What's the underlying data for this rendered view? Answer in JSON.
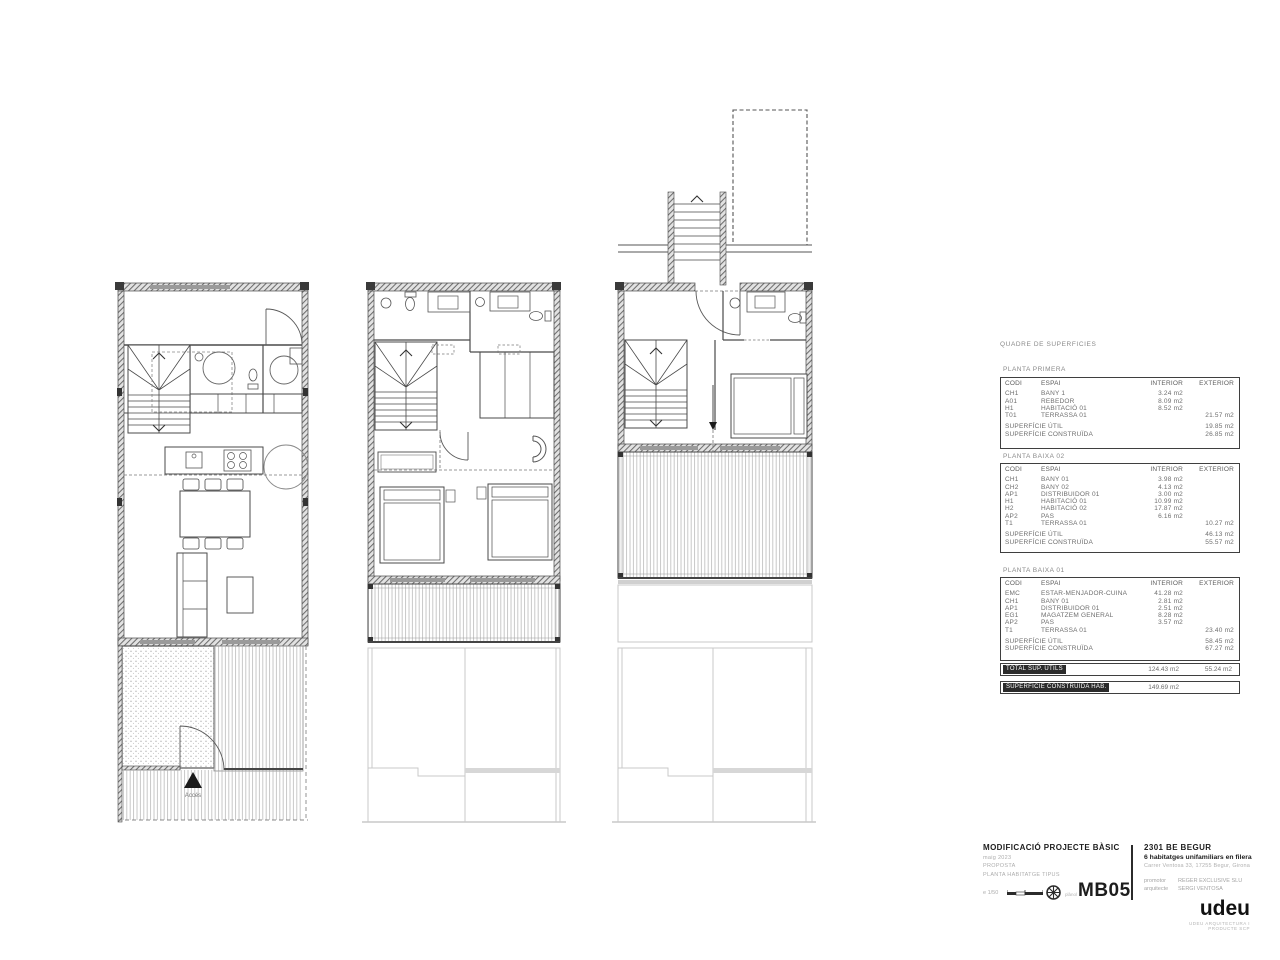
{
  "sheet": {
    "background": "#ffffff",
    "line_color": "#4a4a4a",
    "ghost_color": "#c9c9c9"
  },
  "plans": {
    "acces_label": "Accés"
  },
  "surfaces": {
    "title": "QUADRE DE SUPERFICIES",
    "col_headers": [
      "CODI",
      "ESPAI",
      "INTERIOR",
      "EXTERIOR"
    ],
    "util_label": "SUPERFÍCIE ÚTIL",
    "construida_label": "SUPERFÍCIE CONSTRUÏDA",
    "tables": [
      {
        "name": "PLANTA PRIMERA",
        "rows": [
          {
            "codi": "CH1",
            "espai": "BANY 1",
            "interior": "3.24 m2",
            "exterior": ""
          },
          {
            "codi": "A01",
            "espai": "REBEDOR",
            "interior": "8.09 m2",
            "exterior": ""
          },
          {
            "codi": "H1",
            "espai": "HABITACIÓ 01",
            "interior": "8.52 m2",
            "exterior": ""
          },
          {
            "codi": "T01",
            "espai": "TERRASSA 01",
            "interior": "",
            "exterior": "21.57 m2"
          }
        ],
        "util": "19.85 m2",
        "construida": "26.85 m2"
      },
      {
        "name": "PLANTA BAIXA 02",
        "rows": [
          {
            "codi": "CH1",
            "espai": "BANY 01",
            "interior": "3.98 m2",
            "exterior": ""
          },
          {
            "codi": "CH2",
            "espai": "BANY 02",
            "interior": "4.13 m2",
            "exterior": ""
          },
          {
            "codi": "AP1",
            "espai": "DISTRIBUIDOR 01",
            "interior": "3.00 m2",
            "exterior": ""
          },
          {
            "codi": "H1",
            "espai": "HABITACIÓ 01",
            "interior": "10.99 m2",
            "exterior": ""
          },
          {
            "codi": "H2",
            "espai": "HABITACIÓ 02",
            "interior": "17.87 m2",
            "exterior": ""
          },
          {
            "codi": "AP2",
            "espai": "PAS",
            "interior": "6.16 m2",
            "exterior": ""
          },
          {
            "codi": "T1",
            "espai": "TERRASSA 01",
            "interior": "",
            "exterior": "10.27 m2"
          }
        ],
        "util": "46.13 m2",
        "construida": "55.57 m2"
      },
      {
        "name": "PLANTA BAIXA 01",
        "rows": [
          {
            "codi": "EMC",
            "espai": "ESTAR-MENJADOR-CUINA",
            "interior": "41.28 m2",
            "exterior": ""
          },
          {
            "codi": "CH1",
            "espai": "BANY 01",
            "interior": "2.81 m2",
            "exterior": ""
          },
          {
            "codi": "AP1",
            "espai": "DISTRIBUIDOR 01",
            "interior": "2.51 m2",
            "exterior": ""
          },
          {
            "codi": "EG1",
            "espai": "MAGATZEM GENERAL",
            "interior": "8.28 m2",
            "exterior": ""
          },
          {
            "codi": "AP2",
            "espai": "PAS",
            "interior": "3.57 m2",
            "exterior": ""
          },
          {
            "codi": "T1",
            "espai": "TERRASSA 01",
            "interior": "",
            "exterior": "23.40 m2"
          }
        ],
        "util": "58.45 m2",
        "construida": "67.27 m2"
      }
    ],
    "totals": [
      {
        "label": "TOTAL SUP. ÚTILS",
        "interior": "124.43 m2",
        "exterior": "55.24 m2"
      },
      {
        "label": "SUPERFÍCIE CONSTRUÏDA HAB.",
        "interior": "149.69 m2",
        "exterior": ""
      }
    ]
  },
  "titleblock": {
    "project_type": "MODIFICACIÓ PROJECTE BÀSIC",
    "date": "maig 2023",
    "phase": "PROPOSTA",
    "drawing_name": "PLANTA HABITATGE TIPUS",
    "scale": "e 1/50",
    "sheet_label": "plànol",
    "sheet_code": "MB05",
    "project_code": "2301 BE BEGUR",
    "project_desc": "6 habitatges unifamiliars en filera",
    "address": "Carrer Ventosa 33, 17255 Begur, Girona",
    "promoter_label": "promotor",
    "promoter": "REGER EXCLUSIVE SLU",
    "architect_label": "arquitecte",
    "architect": "SERGI VENTOSA",
    "studio_logo": "udeu",
    "studio_tagline": "UDEU ARQUITECTURA I PRODUCTE SCP"
  }
}
